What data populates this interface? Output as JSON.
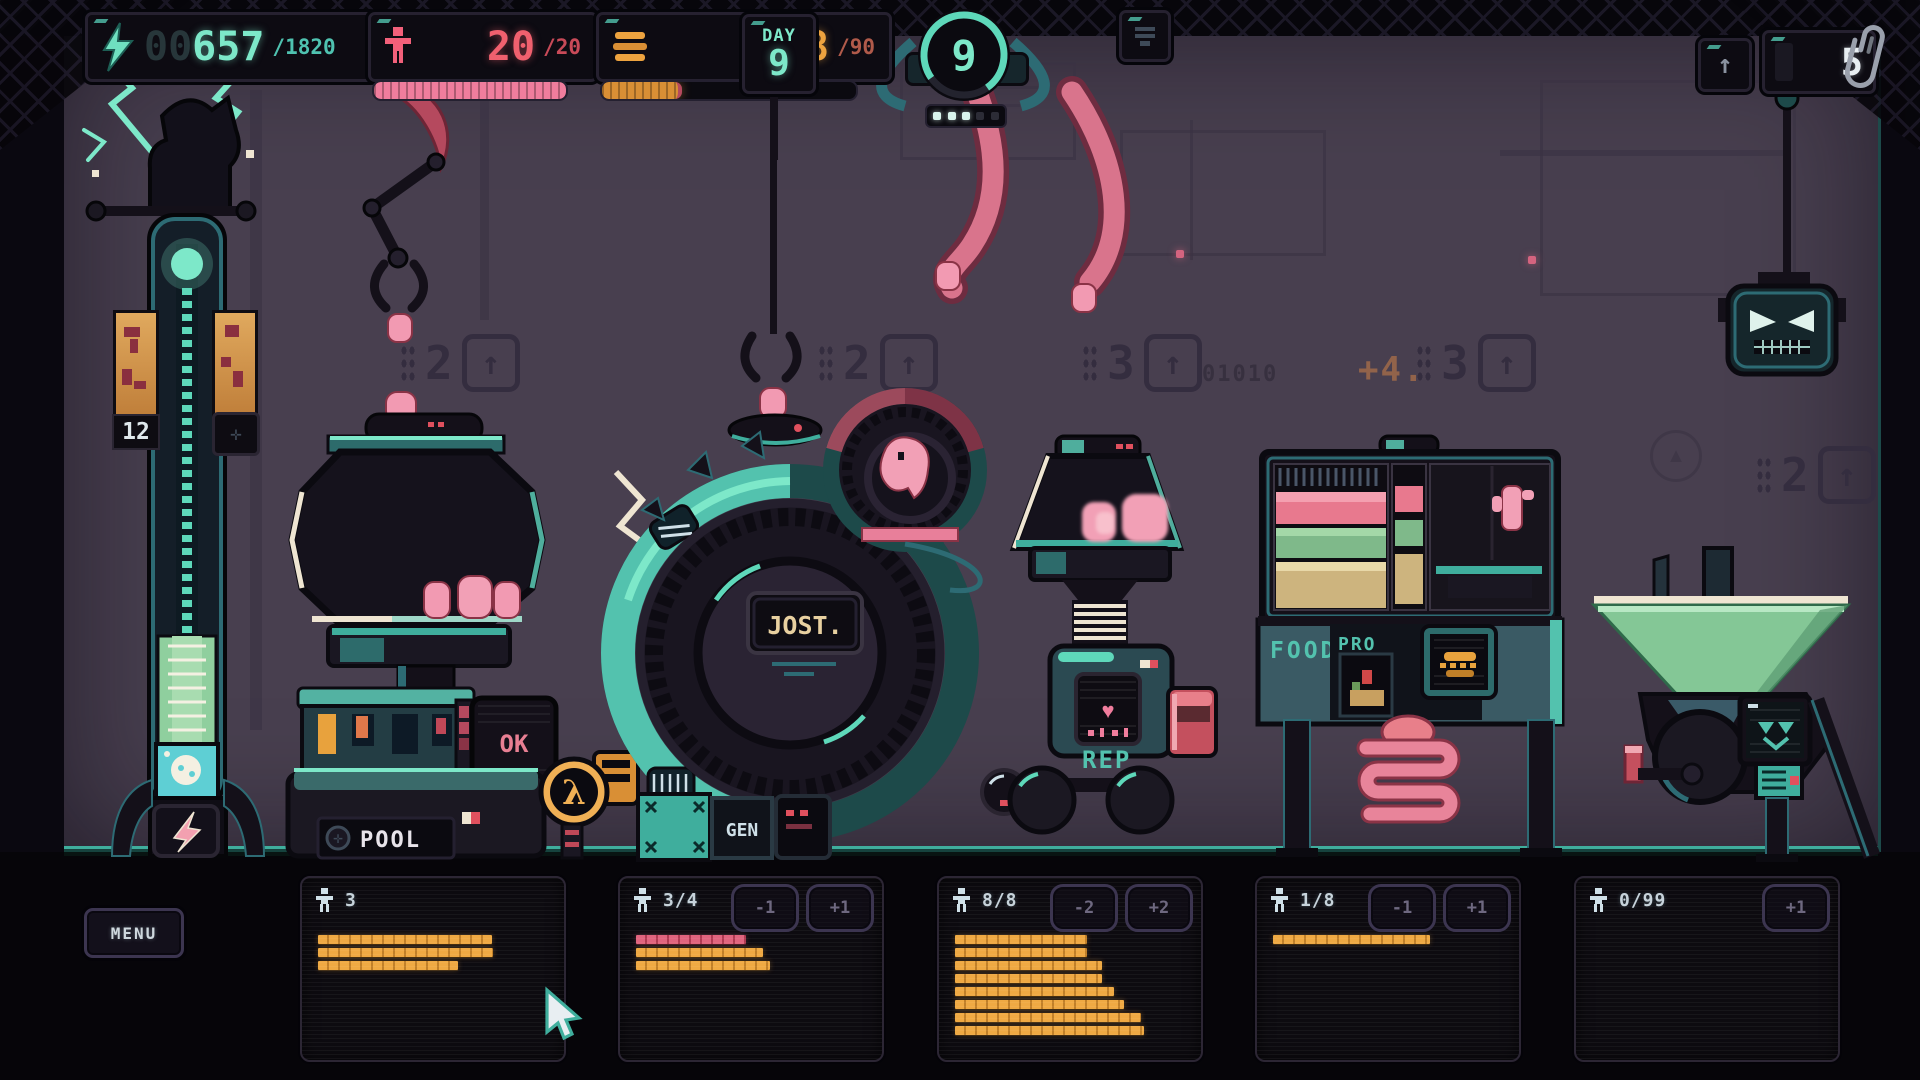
{
  "colors": {
    "teal": "#7de8c9",
    "pink": "#f29ab2",
    "orange": "#eda33f",
    "red_pink": "#ef5f6d",
    "green": "#84c796",
    "maroon": "#9c4a5c"
  },
  "hud": {
    "energy": {
      "pad": "00",
      "value": "657",
      "max": "/1820"
    },
    "population": {
      "value": "20",
      "max": "/20",
      "fill": 1
    },
    "food": {
      "value": "28",
      "max": "/90",
      "fill": 0.3
    },
    "day": {
      "label": "DAY",
      "value": "9"
    },
    "cycle": {
      "value": "9",
      "dots_total": 5,
      "dots_lit": 3
    },
    "upgrade_arrow": "↑",
    "paperclips": {
      "value": "5"
    }
  },
  "tower": {
    "counter": "12",
    "plus": "✛",
    "bolt": "⚡"
  },
  "wall": {
    "binary": "01010",
    "bonus": "+4.",
    "markers": [
      {
        "digit": "2",
        "x": 400,
        "y": 334
      },
      {
        "digit": "2",
        "x": 818,
        "y": 334
      },
      {
        "digit": "3",
        "x": 1082,
        "y": 334
      },
      {
        "digit": "3",
        "x": 1416,
        "y": 334
      },
      {
        "digit": "2",
        "x": 1756,
        "y": 446
      }
    ]
  },
  "machines": {
    "pool": {
      "name": "POOL",
      "ok": "OK",
      "lambda": "λ"
    },
    "jobs": {
      "sign": "JOST.",
      "gen": "GEN"
    },
    "rep": {
      "label": "REP",
      "heart": "♥"
    },
    "food": {
      "label": "FOOD",
      "pro": "PRO"
    }
  },
  "bottom": {
    "menu": "MENU",
    "panels": [
      {
        "count": "3",
        "buttons": [],
        "bars": [
          {
            "color": "orange",
            "w": 174
          },
          {
            "color": "orange",
            "w": 175
          },
          {
            "color": "orange",
            "w": 140
          }
        ]
      },
      {
        "count": "3/4",
        "buttons": [
          "-1",
          "+1"
        ],
        "bars": [
          {
            "color": "pink",
            "w": 110
          },
          {
            "color": "orange",
            "w": 127
          },
          {
            "color": "orange",
            "w": 134
          }
        ]
      },
      {
        "count": "8/8",
        "buttons": [
          "-2",
          "+2"
        ],
        "bars": [
          {
            "color": "orange",
            "w": 132
          },
          {
            "color": "orange",
            "w": 132
          },
          {
            "color": "orange",
            "w": 147
          },
          {
            "color": "orange",
            "w": 147
          },
          {
            "color": "orange",
            "w": 159
          },
          {
            "color": "orange",
            "w": 169
          },
          {
            "color": "orange",
            "w": 186
          },
          {
            "color": "orange",
            "w": 189
          }
        ]
      },
      {
        "count": "1/8",
        "buttons": [
          "-1",
          "+1"
        ],
        "bars": [
          {
            "color": "orange",
            "w": 157
          }
        ]
      },
      {
        "count": "0/99",
        "buttons": [
          "+1"
        ],
        "bars": []
      }
    ]
  }
}
